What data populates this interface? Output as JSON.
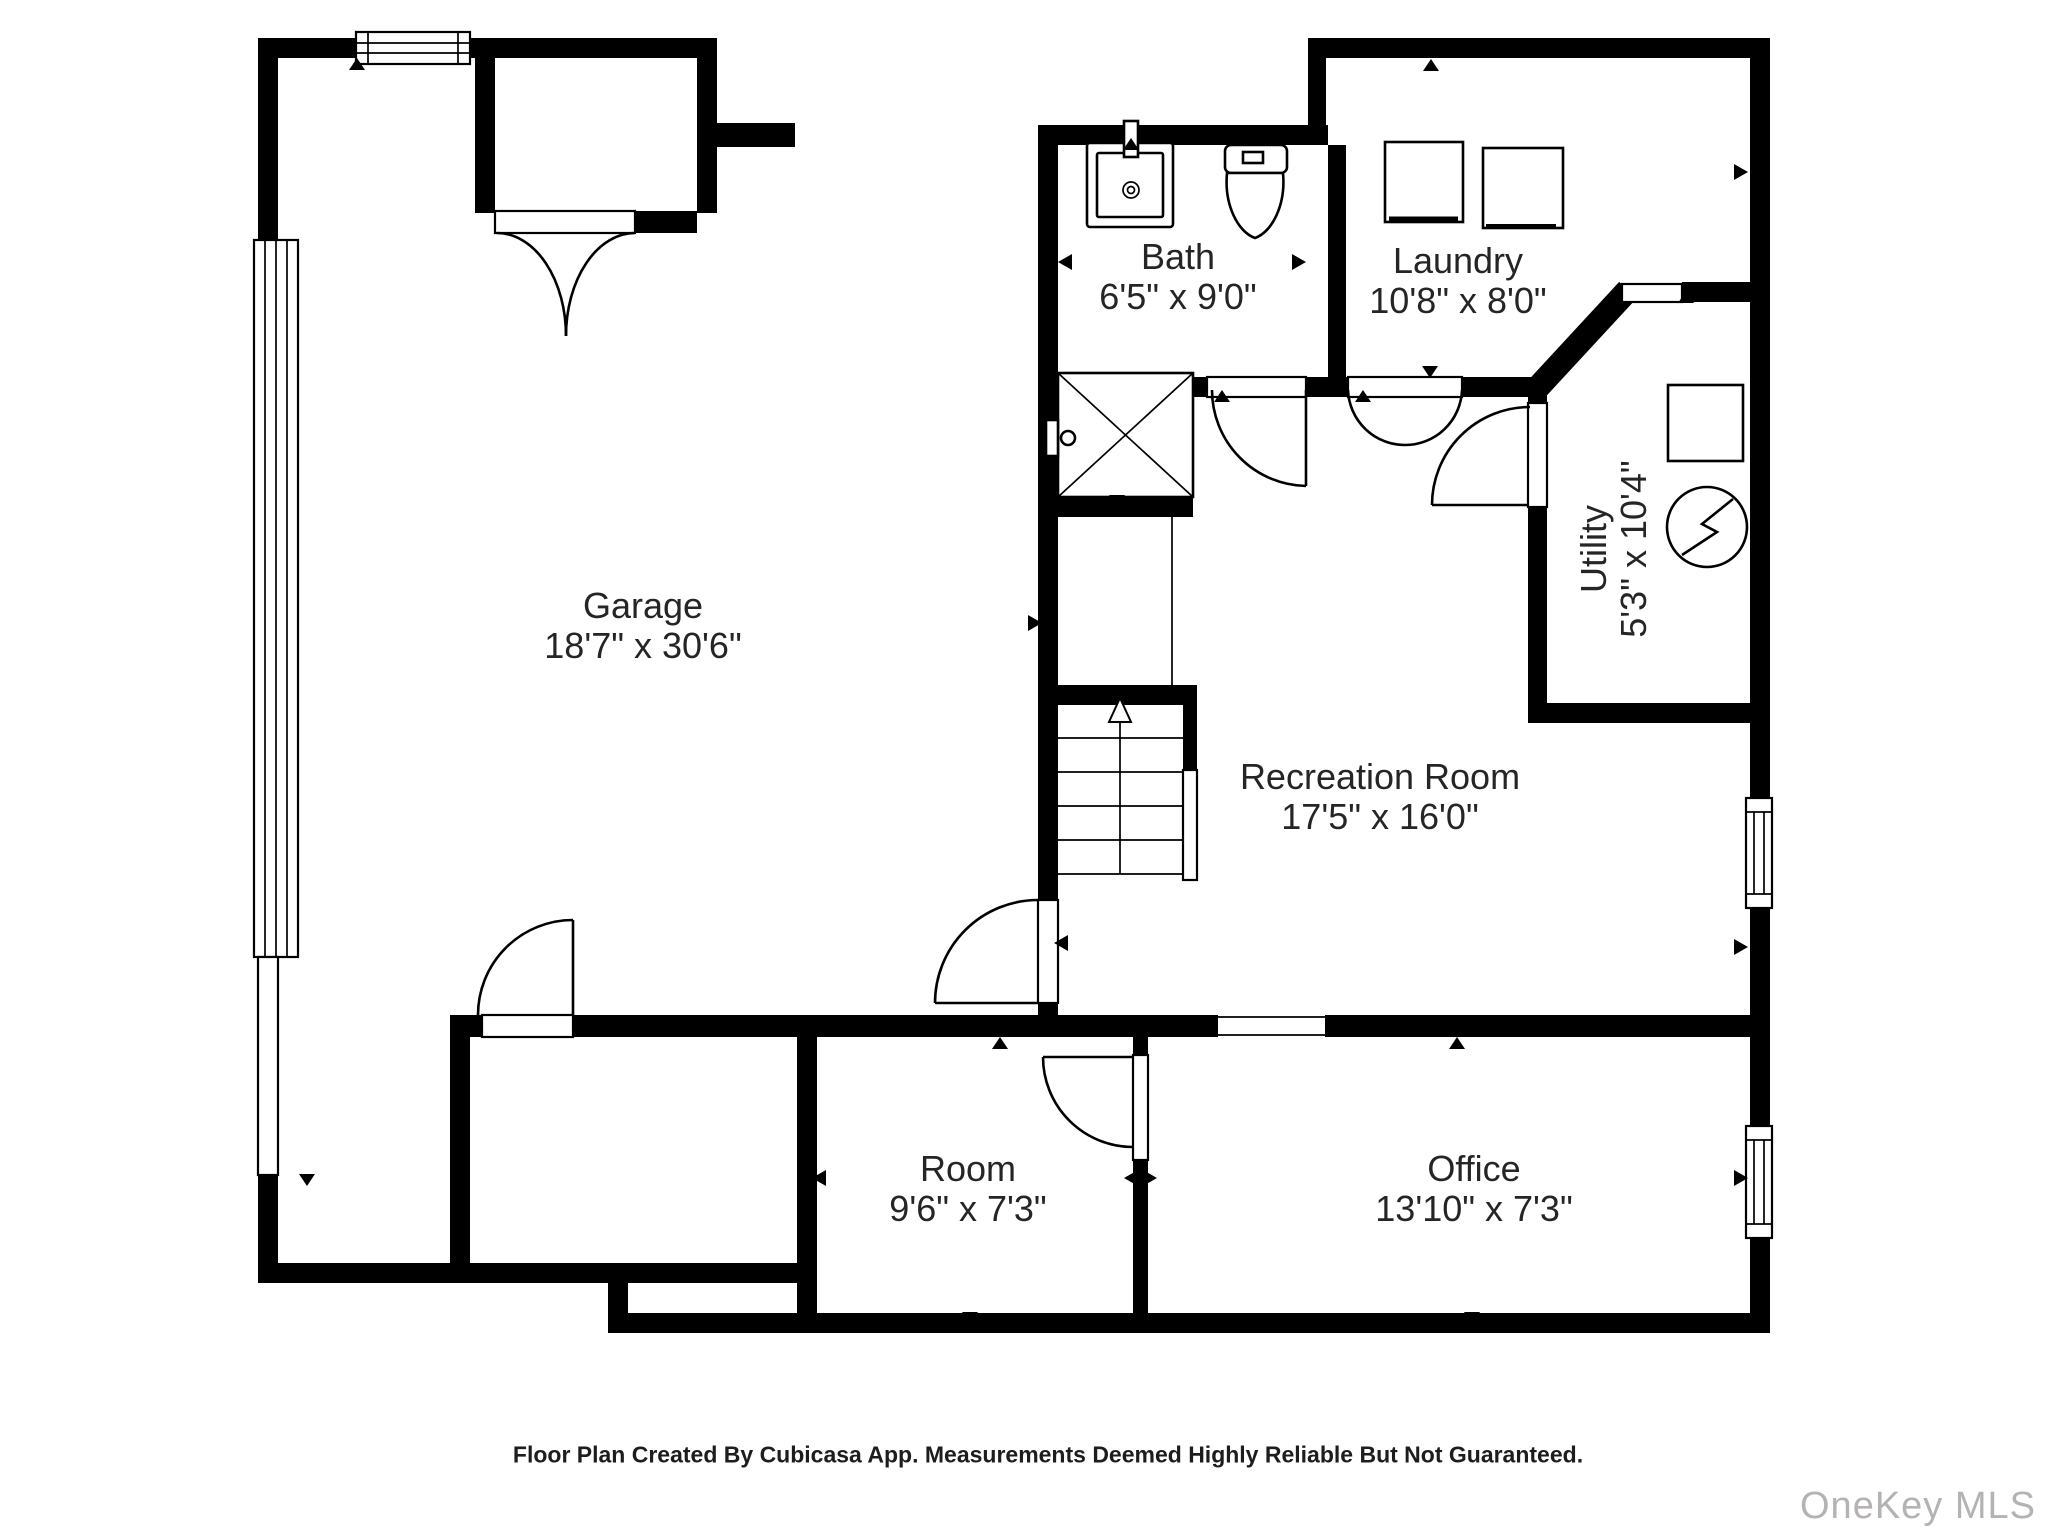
{
  "floor_plan": {
    "rooms": [
      {
        "id": "garage",
        "name": "Garage",
        "dimensions": "18'7\" x 30'6\""
      },
      {
        "id": "bath",
        "name": "Bath",
        "dimensions": "6'5\" x 9'0\""
      },
      {
        "id": "laundry",
        "name": "Laundry",
        "dimensions": "10'8\" x 8'0\""
      },
      {
        "id": "utility",
        "name": "Utility",
        "dimensions": "5'3\" x 10'4\""
      },
      {
        "id": "recreation_room",
        "name": "Recreation Room",
        "dimensions": "17'5\" x 16'0\""
      },
      {
        "id": "room",
        "name": "Room",
        "dimensions": "9'6\" x 7'3\""
      },
      {
        "id": "office",
        "name": "Office",
        "dimensions": "13'10\" x 7'3\""
      }
    ],
    "fixtures": [
      "garage-door",
      "window",
      "storage-closet-double-door",
      "shower",
      "sink",
      "toilet",
      "washer",
      "dryer",
      "water-heater",
      "electrical-panel",
      "stairs-up"
    ],
    "stairs_direction": "up"
  },
  "footer": {
    "text": "Floor Plan Created By Cubicasa App. Measurements Deemed Highly Reliable But Not Guaranteed."
  },
  "watermark": {
    "text": "OneKey MLS"
  },
  "colors": {
    "wall": "#000000",
    "text": "#252525",
    "background": "#ffffff",
    "watermark": "#b5b2b2"
  }
}
